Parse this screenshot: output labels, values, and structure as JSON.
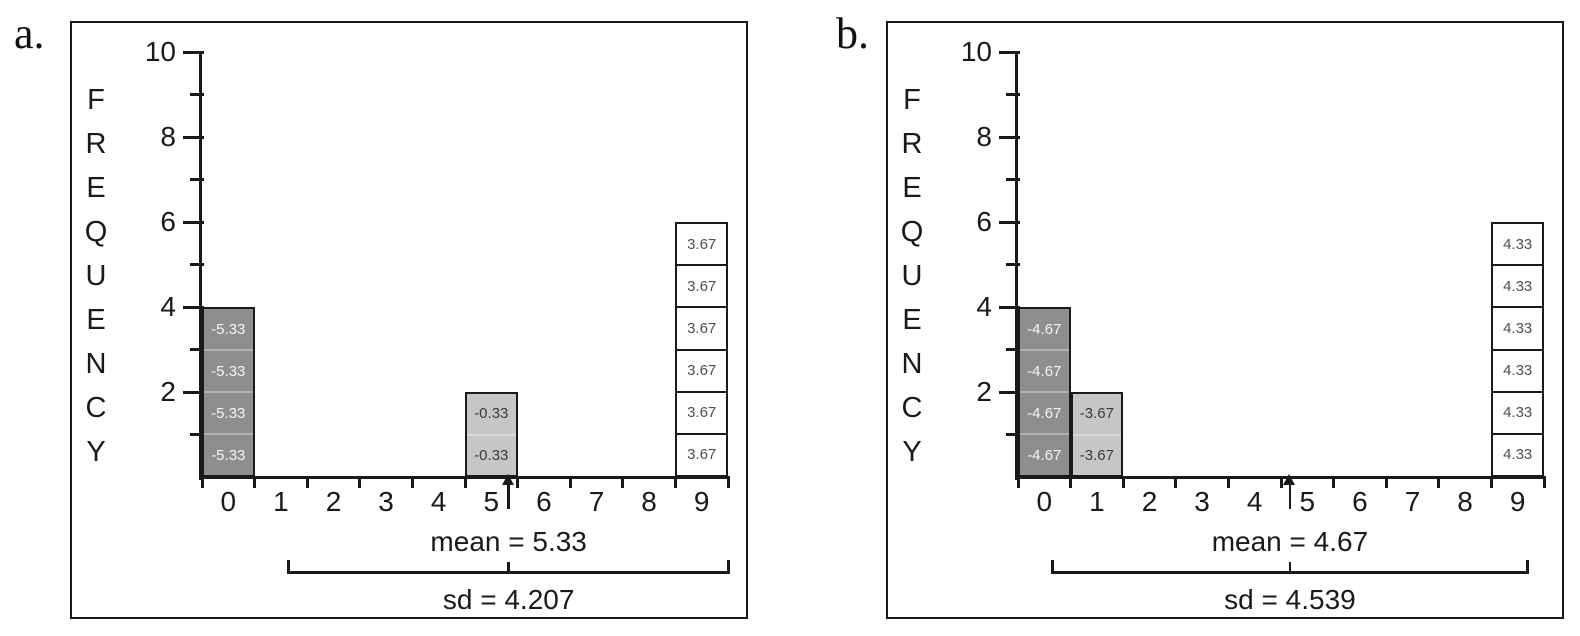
{
  "figure": {
    "background": "#ffffff",
    "ink_color": "#1a1a1a"
  },
  "chart_data": [
    {
      "type": "bar",
      "panel_label": "a.",
      "title": "",
      "xlabel": "",
      "ylabel": "FREQUENCY",
      "ylim": [
        0,
        10
      ],
      "y_major_ticks": [
        10,
        8,
        6,
        4,
        2
      ],
      "y_minor_ticks": [
        9,
        7,
        5,
        3,
        1
      ],
      "categories": [
        "0",
        "1",
        "2",
        "3",
        "4",
        "5",
        "6",
        "7",
        "8",
        "9"
      ],
      "values": [
        4,
        0,
        0,
        0,
        0,
        2,
        0,
        0,
        0,
        6
      ],
      "grid": false,
      "legend": "none",
      "bars": [
        {
          "score": 0,
          "frequency": 4,
          "deviation_label": "-5.33",
          "fill": "#8e8e8e",
          "label_color": "#f4f4f4",
          "divider_color": "#b2b2b2"
        },
        {
          "score": 5,
          "frequency": 2,
          "deviation_label": "-0.33",
          "fill": "#c6c6c6",
          "label_color": "#3a3a3a",
          "divider_color": "#dadada"
        },
        {
          "score": 9,
          "frequency": 6,
          "deviation_label": "3.67",
          "fill": "#ffffff",
          "label_color": "#4f4f4f",
          "divider_color": "#1a1a1a"
        }
      ],
      "mean": 5.33,
      "sd": 4.207,
      "mean_label": "mean = 5.33",
      "sd_label": "sd = 4.207"
    },
    {
      "type": "bar",
      "panel_label": "b.",
      "title": "",
      "xlabel": "",
      "ylabel": "FREQUENCY",
      "ylim": [
        0,
        10
      ],
      "y_major_ticks": [
        10,
        8,
        6,
        4,
        2
      ],
      "y_minor_ticks": [
        9,
        7,
        5,
        3,
        1
      ],
      "categories": [
        "0",
        "1",
        "2",
        "3",
        "4",
        "5",
        "6",
        "7",
        "8",
        "9"
      ],
      "values": [
        4,
        2,
        0,
        0,
        0,
        0,
        0,
        0,
        0,
        6
      ],
      "grid": false,
      "legend": "none",
      "bars": [
        {
          "score": 0,
          "frequency": 4,
          "deviation_label": "-4.67",
          "fill": "#8e8e8e",
          "label_color": "#f4f4f4",
          "divider_color": "#b2b2b2"
        },
        {
          "score": 1,
          "frequency": 2,
          "deviation_label": "-3.67",
          "fill": "#c6c6c6",
          "label_color": "#3a3a3a",
          "divider_color": "#dadada"
        },
        {
          "score": 9,
          "frequency": 6,
          "deviation_label": "4.33",
          "fill": "#ffffff",
          "label_color": "#4f4f4f",
          "divider_color": "#1a1a1a"
        }
      ],
      "mean": 4.67,
      "sd": 4.539,
      "mean_label": "mean = 4.67",
      "sd_label": "sd = 4.539"
    }
  ]
}
